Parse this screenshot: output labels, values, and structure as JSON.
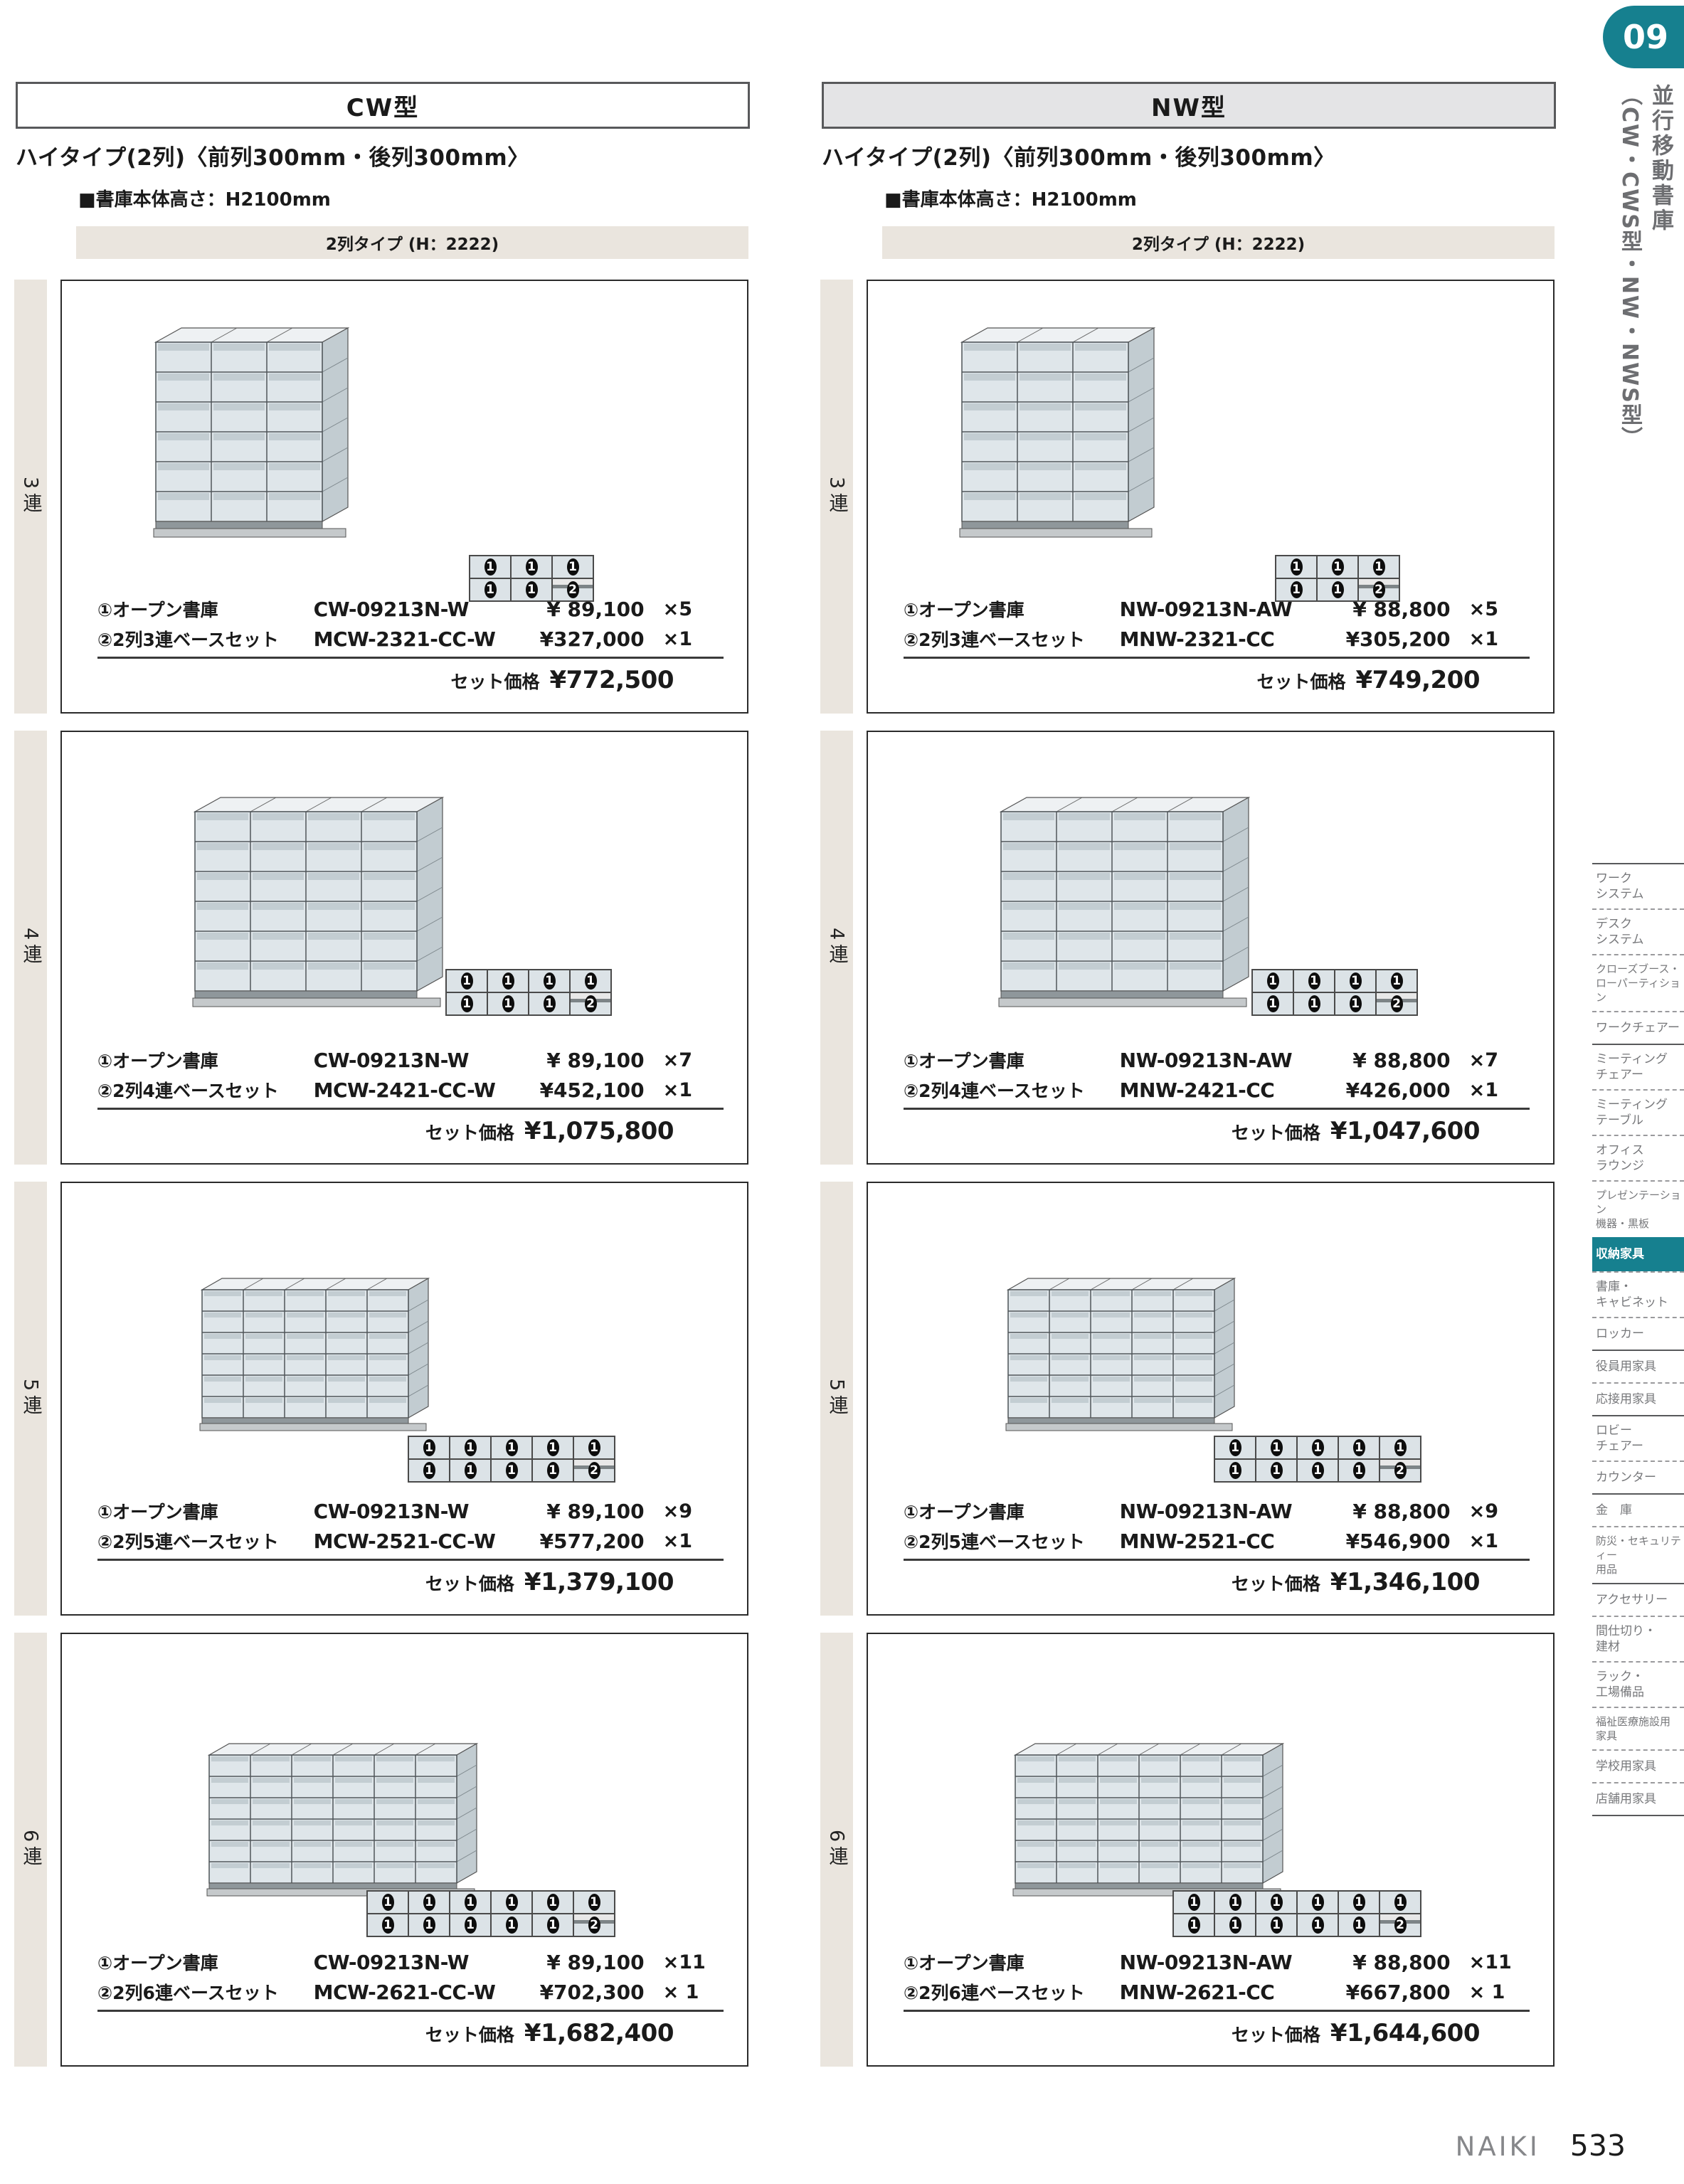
{
  "page": {
    "chapter_badge": "09",
    "side_title_main": "並行移動書庫",
    "side_title_sub": "（CW・CWS型・NW・NWS型）",
    "brand": "NAIKI",
    "page_number": "533"
  },
  "colors": {
    "teal": "#16808f",
    "beige": "#eae5de",
    "header_gray": "#e4e4e6"
  },
  "columns": [
    {
      "header": "CW型",
      "title": "ハイタイプ(2列)〈前列300mm・後列300mm〉",
      "height_note": "■書庫本体高さ：H2100mm",
      "type_bar": "2列タイプ (H：2222)",
      "blocks": [
        {
          "row_label": "3連",
          "units": 3,
          "items": [
            {
              "label": "①オープン書庫",
              "code": "CW-09213N-W",
              "price": "¥ 89,100",
              "qty": "×5"
            },
            {
              "label": "②2列3連ベースセット",
              "code": "MCW-2321-CC-W",
              "price": "¥327,000",
              "qty": "×1"
            }
          ],
          "total_label": "セット価格",
          "total_price": "¥772,500"
        },
        {
          "row_label": "4連",
          "units": 4,
          "items": [
            {
              "label": "①オープン書庫",
              "code": "CW-09213N-W",
              "price": "¥ 89,100",
              "qty": "×7"
            },
            {
              "label": "②2列4連ベースセット",
              "code": "MCW-2421-CC-W",
              "price": "¥452,100",
              "qty": "×1"
            }
          ],
          "total_label": "セット価格",
          "total_price": "¥1,075,800"
        },
        {
          "row_label": "5連",
          "units": 5,
          "items": [
            {
              "label": "①オープン書庫",
              "code": "CW-09213N-W",
              "price": "¥ 89,100",
              "qty": "×9"
            },
            {
              "label": "②2列5連ベースセット",
              "code": "MCW-2521-CC-W",
              "price": "¥577,200",
              "qty": "×1"
            }
          ],
          "total_label": "セット価格",
          "total_price": "¥1,379,100"
        },
        {
          "row_label": "6連",
          "units": 6,
          "items": [
            {
              "label": "①オープン書庫",
              "code": "CW-09213N-W",
              "price": "¥ 89,100",
              "qty": "×11"
            },
            {
              "label": "②2列6連ベースセット",
              "code": "MCW-2621-CC-W",
              "price": "¥702,300",
              "qty": "× 1"
            }
          ],
          "total_label": "セット価格",
          "total_price": "¥1,682,400"
        }
      ]
    },
    {
      "header": "NW型",
      "title": "ハイタイプ(2列)〈前列300mm・後列300mm〉",
      "height_note": "■書庫本体高さ：H2100mm",
      "type_bar": "2列タイプ (H：2222)",
      "blocks": [
        {
          "row_label": "3連",
          "units": 3,
          "items": [
            {
              "label": "①オープン書庫",
              "code": "NW-09213N-AW",
              "price": "¥ 88,800",
              "qty": "×5"
            },
            {
              "label": "②2列3連ベースセット",
              "code": "MNW-2321-CC",
              "price": "¥305,200",
              "qty": "×1"
            }
          ],
          "total_label": "セット価格",
          "total_price": "¥749,200"
        },
        {
          "row_label": "4連",
          "units": 4,
          "items": [
            {
              "label": "①オープン書庫",
              "code": "NW-09213N-AW",
              "price": "¥ 88,800",
              "qty": "×7"
            },
            {
              "label": "②2列4連ベースセット",
              "code": "MNW-2421-CC",
              "price": "¥426,000",
              "qty": "×1"
            }
          ],
          "total_label": "セット価格",
          "total_price": "¥1,047,600"
        },
        {
          "row_label": "5連",
          "units": 5,
          "items": [
            {
              "label": "①オープン書庫",
              "code": "NW-09213N-AW",
              "price": "¥ 88,800",
              "qty": "×9"
            },
            {
              "label": "②2列5連ベースセット",
              "code": "MNW-2521-CC",
              "price": "¥546,900",
              "qty": "×1"
            }
          ],
          "total_label": "セット価格",
          "total_price": "¥1,346,100"
        },
        {
          "row_label": "6連",
          "units": 6,
          "items": [
            {
              "label": "①オープン書庫",
              "code": "NW-09213N-AW",
              "price": "¥ 88,800",
              "qty": "×11"
            },
            {
              "label": "②2列6連ベースセット",
              "code": "MNW-2621-CC",
              "price": "¥667,800",
              "qty": "× 1"
            }
          ],
          "total_label": "セット価格",
          "total_price": "¥1,644,600"
        }
      ]
    }
  ],
  "sidebar": {
    "items": [
      {
        "label": "ワーク\nシステム",
        "divider": "dashed"
      },
      {
        "label": "デスク\nシステム",
        "divider": "dashed"
      },
      {
        "label": "クローズブース・\nローパーティション",
        "small": true,
        "divider": "dashed"
      },
      {
        "label": "ワークチェアー",
        "divider": "solid"
      },
      {
        "label": "ミーティング\nチェアー",
        "divider": "dashed"
      },
      {
        "label": "ミーティング\nテーブル",
        "divider": "dashed"
      },
      {
        "label": "オフィス\nラウンジ",
        "divider": "dashed"
      },
      {
        "label": "プレゼンテーション\n機器・黒板",
        "small": true,
        "divider": "none"
      },
      {
        "label": "収納家具",
        "active": true,
        "divider": "dashed"
      },
      {
        "label": "書庫・\nキャビネット",
        "divider": "dashed"
      },
      {
        "label": "ロッカー",
        "divider": "solid"
      },
      {
        "label": "役員用家具",
        "divider": "dashed"
      },
      {
        "label": "応接用家具",
        "divider": "solid"
      },
      {
        "label": "ロビー\nチェアー",
        "divider": "dashed"
      },
      {
        "label": "カウンター",
        "divider": "solid"
      },
      {
        "label": "金　庫",
        "divider": "dashed"
      },
      {
        "label": "防災・セキュリティー\n用品",
        "small": true,
        "divider": "solid"
      },
      {
        "label": "アクセサリー",
        "divider": "dashed"
      },
      {
        "label": "間仕切り・\n建材",
        "divider": "dashed"
      },
      {
        "label": "ラック・\n工場備品",
        "divider": "dashed"
      },
      {
        "label": "福祉医療施設用\n家具",
        "small": true,
        "divider": "dashed"
      },
      {
        "label": "学校用家具",
        "divider": "dashed"
      },
      {
        "label": "店舗用家具",
        "divider": "solid"
      }
    ]
  }
}
